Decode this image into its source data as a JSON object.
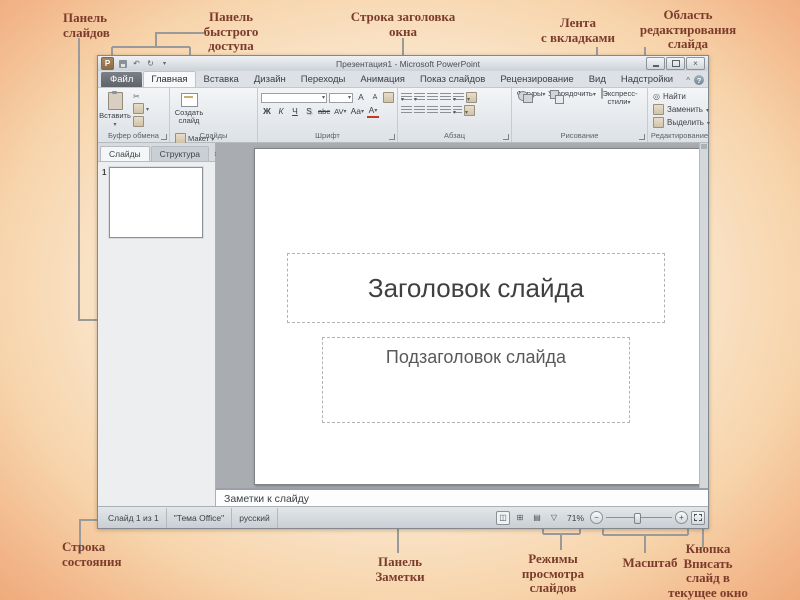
{
  "annotations": {
    "panel_slides": "Панель\nслайдов",
    "quick_access": "Панель\nбыстрого\nдоступа",
    "window_title": "Строка заголовка\nокна",
    "ribbon_tabs": "Лента\nс вкладками",
    "edit_area": "Область\nредактирования\nслайда",
    "status_bar": "Строка\nсостояния",
    "notes_panel": "Панель\nЗаметки",
    "view_modes": "Режимы\nпросмотра\nслайдов",
    "zoom": "Масштаб",
    "fit_window": "Кнопка\nВписать\nслайд в\nтекущее окно"
  },
  "win": {
    "title": "Презентация1 - Microsoft PowerPoint",
    "tabs": [
      "Файл",
      "Главная",
      "Вставка",
      "Дизайн",
      "Переходы",
      "Анимация",
      "Показ слайдов",
      "Рецензирование",
      "Вид",
      "Надстройки"
    ]
  },
  "ribbon": {
    "clipboard": {
      "label": "Буфер обмена",
      "paste": "Вставить"
    },
    "slides": {
      "label": "Слайды",
      "new_slide": "Создать\nслайд",
      "layout": "Макет",
      "reset": "Восстановить",
      "section": "Раздел"
    },
    "font": {
      "label": "Шрифт",
      "bold": "Ж",
      "italic": "К",
      "underline": "Ч",
      "shadow": "S",
      "strike": "abc",
      "spacing": "AV",
      "case": "Aa",
      "color": "А",
      "grow": "A",
      "shrink": "A"
    },
    "paragraph": {
      "label": "Абзац"
    },
    "drawing": {
      "label": "Рисование",
      "shapes": "Фигуры",
      "arrange": "Упорядочить",
      "quick_styles": "Экспресс-стили"
    },
    "editing": {
      "label": "Редактирование",
      "find": "Найти",
      "replace": "Заменить",
      "select": "Выделить"
    }
  },
  "panel": {
    "tab_slides": "Слайды",
    "tab_outline": "Структура",
    "slide_number": "1"
  },
  "slide": {
    "title": "Заголовок слайда",
    "subtitle": "Подзаголовок слайда"
  },
  "notes": {
    "placeholder": "Заметки к слайду"
  },
  "status": {
    "slide_indicator": "Слайд 1 из 1",
    "theme": "\"Тема Office\"",
    "language": "русский",
    "zoom_level": "71%",
    "zoom_out": "−",
    "zoom_in": "+"
  },
  "icons": {
    "close": "×",
    "help": "?",
    "collapse": "^",
    "undo": "↶",
    "redo": "↻",
    "scissors": "✂",
    "pane_close": "×",
    "find_glass": "◎"
  }
}
